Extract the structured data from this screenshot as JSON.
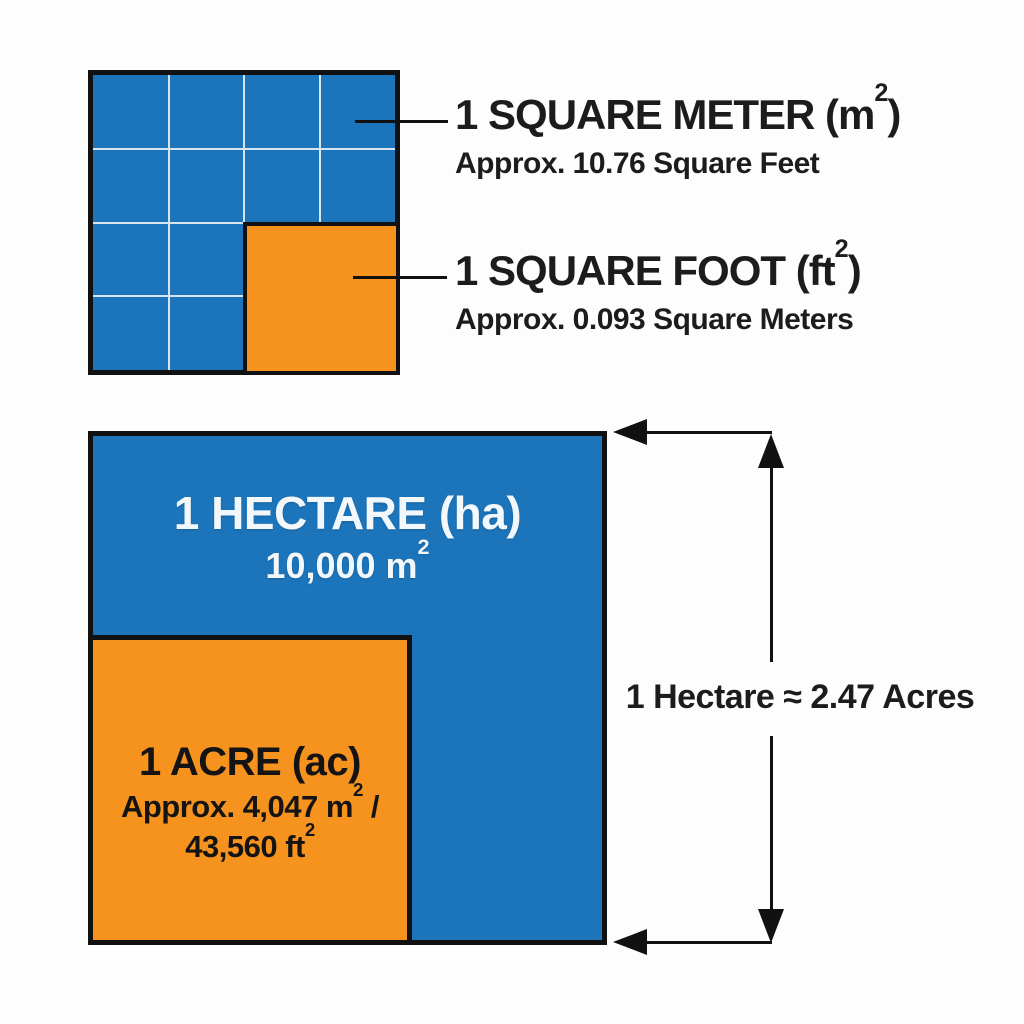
{
  "colors": {
    "blue": "#1c75bb",
    "orange": "#f6921e",
    "line_black": "#111111",
    "text_dark": "#1c1c1c",
    "text_light": "#f2f7fb",
    "grid_line": "#d7e5f2",
    "bg": "#fdfdfd"
  },
  "figure1": {
    "meter_label": {
      "title_pre": "1 SQUARE METER (m",
      "title_sup": "2",
      "title_post": ")",
      "subtitle": "Approx. 10.76 Square Feet"
    },
    "foot_label": {
      "title_pre": "1 SQUARE FOOT (ft",
      "title_sup": "2",
      "title_post": ")",
      "subtitle": "Approx. 0.093 Square Meters"
    }
  },
  "figure2": {
    "hectare": {
      "title": "1 HECTARE (ha)",
      "area_pre": "10,000 m",
      "area_sup": "2"
    },
    "acre": {
      "title": "1 ACRE (ac)",
      "line2_pre": "Approx. 4,047 m",
      "line2_sup": "2",
      "line2_post": " /",
      "line3_pre": "43,560 ft",
      "line3_sup": "2"
    },
    "dimension_label": "1 Hectare ≈ 2.47 Acres"
  }
}
